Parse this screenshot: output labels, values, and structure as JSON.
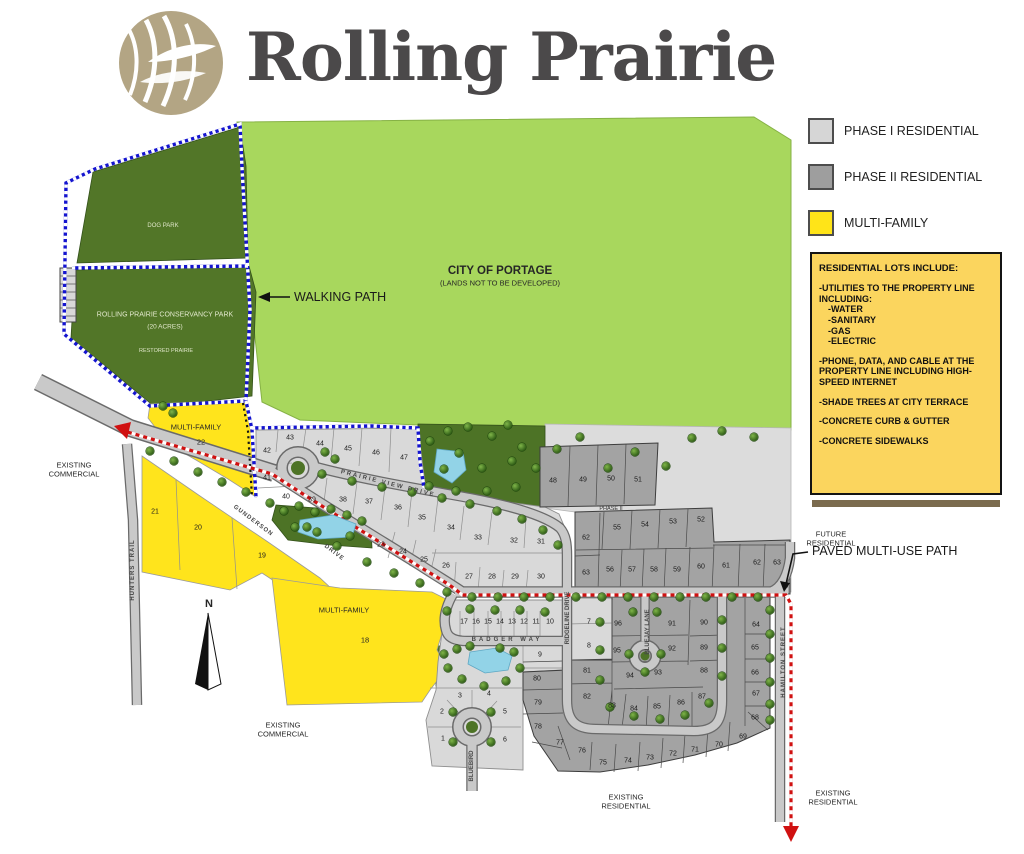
{
  "title": "Rolling Prairie",
  "colors": {
    "phase1_gray": "#d9d9d9",
    "phase2_gray": "#a3a3a3",
    "multi_family_yellow": "#ffe41c",
    "info_box_yellow": "#fbd55e",
    "park_green": "#527628",
    "city_green": "#a8d75d",
    "walking_path_blue": "#1414cf",
    "multi_use_path_red": "#d01111",
    "logo_tan": "#b3a584"
  },
  "legend": {
    "items": [
      {
        "name": "phase-1-swatch",
        "label": "PHASE I RESIDENTIAL",
        "color": "#d6d6d6"
      },
      {
        "name": "phase-2-swatch",
        "label": "PHASE II RESIDENTIAL",
        "color": "#9e9e9e"
      },
      {
        "name": "multi-family-swatch",
        "label": "MULTI-FAMILY",
        "color": "#ffe418"
      }
    ]
  },
  "info_box": {
    "lines": [
      {
        "style": "heading",
        "text": "RESIDENTIAL LOTS INCLUDE:"
      },
      {
        "style": "item",
        "text": "-UTILITIES TO THE PROPERTY LINE INCLUDING:"
      },
      {
        "style": "sub",
        "text": "-WATER"
      },
      {
        "style": "sub",
        "text": "-SANITARY"
      },
      {
        "style": "sub",
        "text": "-GAS"
      },
      {
        "style": "sub",
        "text": "-ELECTRIC"
      },
      {
        "style": "item",
        "text": "-PHONE, DATA, AND CABLE AT THE PROPERTY LINE INCLUDING HIGH-SPEED INTERNET"
      },
      {
        "style": "item",
        "text": "-SHADE TREES AT CITY TERRACE"
      },
      {
        "style": "item",
        "text": "-CONCRETE CURB & GUTTER"
      },
      {
        "style": "item",
        "text": "-CONCRETE SIDEWALKS"
      }
    ]
  },
  "map": {
    "city": {
      "l1": "CITY OF PORTAGE",
      "l2": "(LANDS NOT TO BE DEVELOPED)"
    },
    "dog_park": "DOG PARK",
    "conservancy": {
      "l1": "ROLLING PRAIRIE CONSERVANCY PARK",
      "l2": "(20 ACRES)",
      "l3": "RESTORED PRAIRIE"
    },
    "walking_path": "WALKING PATH",
    "paved_path": "PAVED MULTI-USE PATH",
    "mf22": {
      "l1": "MULTI-FAMILY",
      "n": "22"
    },
    "mf18": {
      "l1": "MULTI-FAMILY",
      "n": "18"
    },
    "existing_commercial": {
      "l1": "EXISTING",
      "l2": "COMMERCIAL"
    },
    "existing_residential": {
      "l1": "EXISTING",
      "l2": "RESIDENTIAL"
    },
    "future_residential": {
      "l1": "FUTURE",
      "l2": "RESIDENTIAL"
    },
    "phase_ii": "PHASE II",
    "north": "N",
    "streets": [
      {
        "text": "PRAIRIE VIEW DRIVE",
        "x": 388,
        "y": 484,
        "rot": 14,
        "ls": 2
      },
      {
        "text": "GUNDERSON",
        "x": 253,
        "y": 521,
        "rot": 37,
        "ls": 1
      },
      {
        "text": "DRIVE",
        "x": 334,
        "y": 553,
        "rot": 37,
        "ls": 1
      },
      {
        "text": "BADGER  WAY",
        "x": 507,
        "y": 640,
        "rot": 0,
        "ls": 3
      },
      {
        "text": "HUNTERS TRAIL",
        "x": 133,
        "y": 570,
        "rot": -90,
        "ls": 1
      },
      {
        "text": "RIDGELINE DRIVE",
        "x": 568,
        "y": 618,
        "rot": -90,
        "ls": 0
      },
      {
        "text": "BLUEJAY LANE",
        "x": 648,
        "y": 632,
        "rot": -90,
        "ls": 0
      },
      {
        "text": "HAMILTON STREET",
        "x": 784,
        "y": 662,
        "rot": -90,
        "ls": 1
      },
      {
        "text": "BLUEBIRD",
        "x": 472,
        "y": 766,
        "rot": -90,
        "ls": 0
      }
    ],
    "lots": [
      {
        "n": "1",
        "x": 443,
        "y": 739
      },
      {
        "n": "2",
        "x": 442,
        "y": 712
      },
      {
        "n": "3",
        "x": 460,
        "y": 696
      },
      {
        "n": "4",
        "x": 489,
        "y": 694
      },
      {
        "n": "5",
        "x": 505,
        "y": 712
      },
      {
        "n": "6",
        "x": 505,
        "y": 740
      },
      {
        "n": "7",
        "x": 589,
        "y": 622
      },
      {
        "n": "8",
        "x": 589,
        "y": 646
      },
      {
        "n": "9",
        "x": 540,
        "y": 655
      },
      {
        "n": "10",
        "x": 550,
        "y": 622
      },
      {
        "n": "11",
        "x": 536,
        "y": 622
      },
      {
        "n": "12",
        "x": 524,
        "y": 622
      },
      {
        "n": "13",
        "x": 512,
        "y": 622
      },
      {
        "n": "14",
        "x": 500,
        "y": 622
      },
      {
        "n": "15",
        "x": 488,
        "y": 622
      },
      {
        "n": "16",
        "x": 476,
        "y": 622
      },
      {
        "n": "17",
        "x": 464,
        "y": 622
      },
      {
        "n": "19",
        "x": 262,
        "y": 556
      },
      {
        "n": "20",
        "x": 198,
        "y": 528
      },
      {
        "n": "21",
        "x": 155,
        "y": 512
      },
      {
        "n": "23",
        "x": 381,
        "y": 545
      },
      {
        "n": "24",
        "x": 403,
        "y": 552
      },
      {
        "n": "25",
        "x": 424,
        "y": 560
      },
      {
        "n": "26",
        "x": 446,
        "y": 566
      },
      {
        "n": "27",
        "x": 469,
        "y": 577
      },
      {
        "n": "28",
        "x": 492,
        "y": 577
      },
      {
        "n": "29",
        "x": 515,
        "y": 577
      },
      {
        "n": "30",
        "x": 541,
        "y": 577
      },
      {
        "n": "31",
        "x": 541,
        "y": 542
      },
      {
        "n": "32",
        "x": 514,
        "y": 541
      },
      {
        "n": "33",
        "x": 478,
        "y": 538
      },
      {
        "n": "34",
        "x": 451,
        "y": 528
      },
      {
        "n": "35",
        "x": 422,
        "y": 518
      },
      {
        "n": "36",
        "x": 398,
        "y": 508
      },
      {
        "n": "37",
        "x": 369,
        "y": 502
      },
      {
        "n": "38",
        "x": 343,
        "y": 500
      },
      {
        "n": "39",
        "x": 312,
        "y": 500
      },
      {
        "n": "40",
        "x": 286,
        "y": 497
      },
      {
        "n": "41",
        "x": 267,
        "y": 478
      },
      {
        "n": "42",
        "x": 267,
        "y": 451
      },
      {
        "n": "43",
        "x": 290,
        "y": 438
      },
      {
        "n": "44",
        "x": 320,
        "y": 444
      },
      {
        "n": "45",
        "x": 348,
        "y": 449
      },
      {
        "n": "46",
        "x": 376,
        "y": 453
      },
      {
        "n": "47",
        "x": 404,
        "y": 458
      },
      {
        "n": "48",
        "x": 553,
        "y": 481
      },
      {
        "n": "49",
        "x": 583,
        "y": 480
      },
      {
        "n": "50",
        "x": 611,
        "y": 479
      },
      {
        "n": "51",
        "x": 638,
        "y": 480
      },
      {
        "n": "52",
        "x": 701,
        "y": 520
      },
      {
        "n": "53",
        "x": 673,
        "y": 522
      },
      {
        "n": "54",
        "x": 645,
        "y": 525
      },
      {
        "n": "55",
        "x": 617,
        "y": 528
      },
      {
        "n": "56",
        "x": 610,
        "y": 570
      },
      {
        "n": "57",
        "x": 632,
        "y": 570
      },
      {
        "n": "58",
        "x": 654,
        "y": 570
      },
      {
        "n": "59",
        "x": 677,
        "y": 570
      },
      {
        "n": "60",
        "x": 701,
        "y": 567
      },
      {
        "n": "61",
        "x": 726,
        "y": 566
      },
      {
        "n": "62",
        "x": 586,
        "y": 538
      },
      {
        "n": "63",
        "x": 586,
        "y": 573
      },
      {
        "n": "62",
        "x": 757,
        "y": 563
      },
      {
        "n": "63",
        "x": 777,
        "y": 563
      },
      {
        "n": "64",
        "x": 756,
        "y": 625
      },
      {
        "n": "65",
        "x": 755,
        "y": 648
      },
      {
        "n": "66",
        "x": 755,
        "y": 673
      },
      {
        "n": "67",
        "x": 756,
        "y": 694
      },
      {
        "n": "68",
        "x": 755,
        "y": 718
      },
      {
        "n": "69",
        "x": 743,
        "y": 737
      },
      {
        "n": "70",
        "x": 719,
        "y": 745
      },
      {
        "n": "71",
        "x": 695,
        "y": 750
      },
      {
        "n": "72",
        "x": 673,
        "y": 754
      },
      {
        "n": "73",
        "x": 650,
        "y": 758
      },
      {
        "n": "74",
        "x": 628,
        "y": 761
      },
      {
        "n": "75",
        "x": 603,
        "y": 763
      },
      {
        "n": "76",
        "x": 582,
        "y": 751
      },
      {
        "n": "77",
        "x": 560,
        "y": 743
      },
      {
        "n": "78",
        "x": 538,
        "y": 727
      },
      {
        "n": "79",
        "x": 538,
        "y": 703
      },
      {
        "n": "80",
        "x": 537,
        "y": 679
      },
      {
        "n": "81",
        "x": 587,
        "y": 671
      },
      {
        "n": "82",
        "x": 587,
        "y": 697
      },
      {
        "n": "83",
        "x": 612,
        "y": 706
      },
      {
        "n": "84",
        "x": 634,
        "y": 709
      },
      {
        "n": "85",
        "x": 657,
        "y": 707
      },
      {
        "n": "86",
        "x": 681,
        "y": 703
      },
      {
        "n": "87",
        "x": 702,
        "y": 697
      },
      {
        "n": "88",
        "x": 704,
        "y": 671
      },
      {
        "n": "89",
        "x": 704,
        "y": 648
      },
      {
        "n": "90",
        "x": 704,
        "y": 623
      },
      {
        "n": "91",
        "x": 672,
        "y": 624
      },
      {
        "n": "92",
        "x": 672,
        "y": 649
      },
      {
        "n": "93",
        "x": 658,
        "y": 673
      },
      {
        "n": "94",
        "x": 630,
        "y": 676
      },
      {
        "n": "95",
        "x": 617,
        "y": 651
      },
      {
        "n": "96",
        "x": 618,
        "y": 624
      }
    ],
    "trees": [
      [
        430,
        441
      ],
      [
        448,
        431
      ],
      [
        468,
        427
      ],
      [
        492,
        436
      ],
      [
        508,
        425
      ],
      [
        522,
        447
      ],
      [
        536,
        468
      ],
      [
        512,
        461
      ],
      [
        482,
        468
      ],
      [
        459,
        453
      ],
      [
        444,
        469
      ],
      [
        429,
        486
      ],
      [
        456,
        491
      ],
      [
        487,
        491
      ],
      [
        516,
        487
      ],
      [
        557,
        449
      ],
      [
        580,
        437
      ],
      [
        608,
        468
      ],
      [
        635,
        452
      ],
      [
        666,
        466
      ],
      [
        692,
        438
      ],
      [
        722,
        431
      ],
      [
        754,
        437
      ],
      [
        284,
        511
      ],
      [
        299,
        506
      ],
      [
        315,
        512
      ],
      [
        331,
        509
      ],
      [
        347,
        515
      ],
      [
        362,
        521
      ],
      [
        295,
        527
      ],
      [
        317,
        532
      ],
      [
        350,
        536
      ],
      [
        444,
        654
      ],
      [
        457,
        649
      ],
      [
        470,
        646
      ],
      [
        500,
        648
      ],
      [
        514,
        652
      ],
      [
        448,
        668
      ],
      [
        462,
        679
      ],
      [
        484,
        686
      ],
      [
        506,
        681
      ],
      [
        520,
        668
      ],
      [
        163,
        406
      ],
      [
        173,
        413
      ],
      [
        325,
        452
      ],
      [
        335,
        459
      ],
      [
        150,
        451
      ],
      [
        174,
        461
      ],
      [
        198,
        472
      ],
      [
        222,
        482
      ],
      [
        246,
        492
      ],
      [
        270,
        503
      ],
      [
        307,
        527
      ],
      [
        337,
        546
      ],
      [
        367,
        562
      ],
      [
        394,
        573
      ],
      [
        420,
        583
      ],
      [
        447,
        592
      ],
      [
        472,
        597
      ],
      [
        498,
        597
      ],
      [
        524,
        597
      ],
      [
        550,
        597
      ],
      [
        576,
        597
      ],
      [
        602,
        597
      ],
      [
        628,
        597
      ],
      [
        654,
        597
      ],
      [
        680,
        597
      ],
      [
        706,
        597
      ],
      [
        732,
        597
      ],
      [
        758,
        597
      ],
      [
        322,
        474
      ],
      [
        352,
        481
      ],
      [
        382,
        487
      ],
      [
        412,
        492
      ],
      [
        442,
        498
      ],
      [
        470,
        504
      ],
      [
        497,
        511
      ],
      [
        522,
        519
      ],
      [
        543,
        530
      ],
      [
        558,
        545
      ],
      [
        600,
        622
      ],
      [
        600,
        650
      ],
      [
        600,
        680
      ],
      [
        610,
        707
      ],
      [
        634,
        716
      ],
      [
        660,
        719
      ],
      [
        685,
        715
      ],
      [
        709,
        703
      ],
      [
        722,
        676
      ],
      [
        722,
        648
      ],
      [
        722,
        620
      ],
      [
        770,
        610
      ],
      [
        770,
        634
      ],
      [
        770,
        658
      ],
      [
        770,
        682
      ],
      [
        770,
        704
      ],
      [
        770,
        720
      ],
      [
        633,
        612
      ],
      [
        657,
        612
      ],
      [
        645,
        672
      ],
      [
        629,
        654
      ],
      [
        661,
        654
      ],
      [
        447,
        611
      ],
      [
        470,
        609
      ],
      [
        495,
        610
      ],
      [
        520,
        610
      ],
      [
        545,
        612
      ],
      [
        453,
        712
      ],
      [
        491,
        712
      ],
      [
        453,
        742
      ],
      [
        491,
        742
      ]
    ]
  }
}
